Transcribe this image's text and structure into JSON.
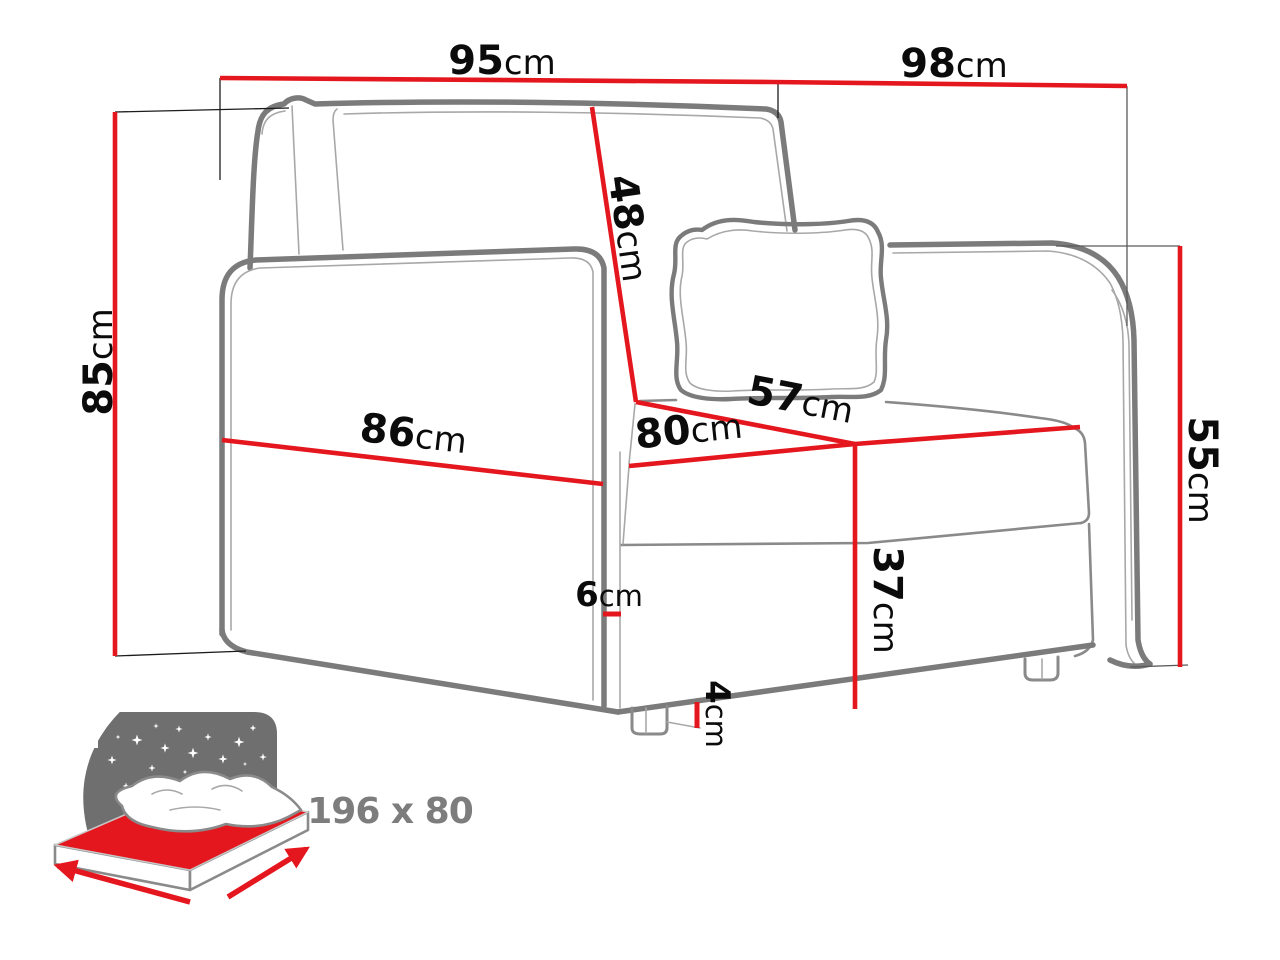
{
  "diagram": {
    "type": "furniture-dimension-diagram",
    "subject": "armchair sofa-bed line drawing with dimension callouts"
  },
  "dimensions": {
    "total_width": {
      "value": "95",
      "unit": "cm"
    },
    "total_depth": {
      "value": "98",
      "unit": "cm"
    },
    "total_height": {
      "value": "85",
      "unit": "cm"
    },
    "backrest_height": {
      "value": "48",
      "unit": "cm"
    },
    "seat_depth": {
      "value": "57",
      "unit": "cm"
    },
    "seat_width": {
      "value": "80",
      "unit": "cm"
    },
    "armrest_span": {
      "value": "86",
      "unit": "cm"
    },
    "armrest_height": {
      "value": "55",
      "unit": "cm"
    },
    "seat_height": {
      "value": "37",
      "unit": "cm"
    },
    "armrest_thickness": {
      "value": "6",
      "unit": "cm"
    },
    "leg_height": {
      "value": "4",
      "unit": "cm"
    }
  },
  "sleeping_area": {
    "label": "196 x 80"
  },
  "colors": {
    "dimension_red": "#e5171e",
    "line_gray": "#7b7b7b",
    "detail_gray": "#a8a8a8",
    "text_black": "#0b0b0b",
    "icon_gray": "#6f6f6f",
    "icon_label_gray": "#7d7d7d"
  }
}
